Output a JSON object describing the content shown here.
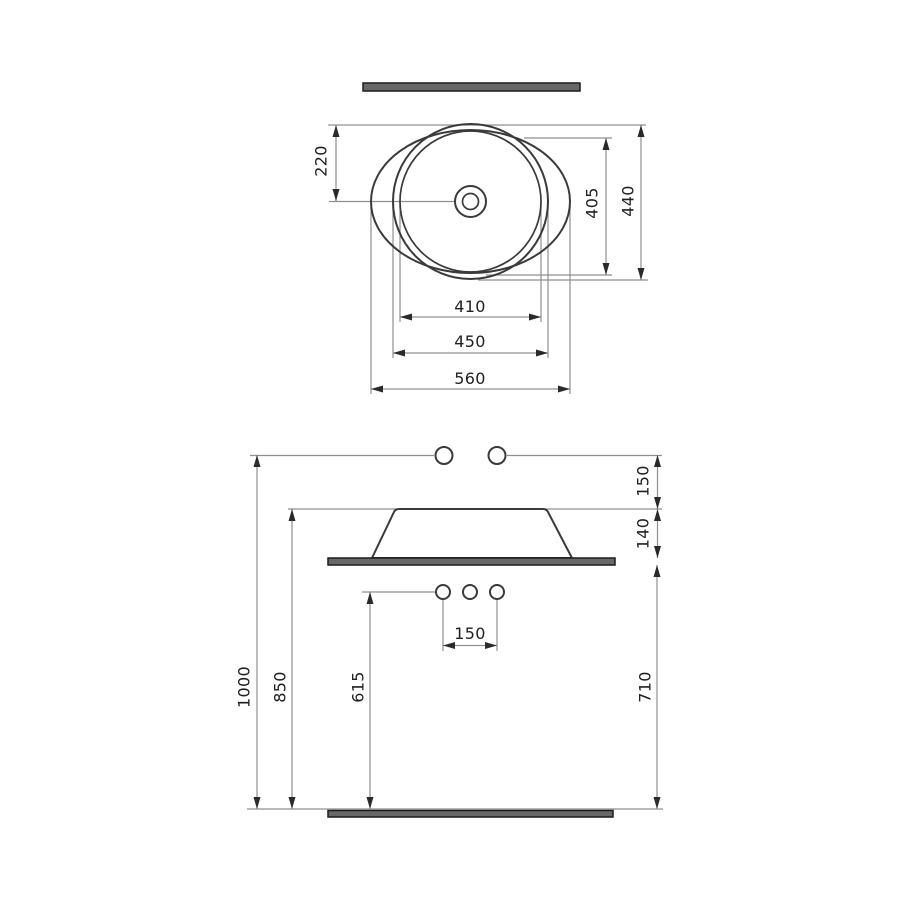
{
  "drawing": {
    "top_view": {
      "labels": {
        "center_offset": "220",
        "inner_height": "405",
        "overall_height": "440",
        "inner_width": "410",
        "rim_width": "450",
        "overall_width": "560"
      }
    },
    "front_view": {
      "labels": {
        "wall_to_rim": "150",
        "basin_height": "140",
        "overall_height": "1000",
        "rim_height": "850",
        "hole_height": "615",
        "hole_spacing": "150",
        "counter_height": "710"
      }
    },
    "colors": {
      "object_line": "#3a3a3a",
      "dimension_line": "#8f8f8f",
      "bar_fill": "#686868",
      "text": "#1f1f1f",
      "background": "#ffffff"
    }
  }
}
